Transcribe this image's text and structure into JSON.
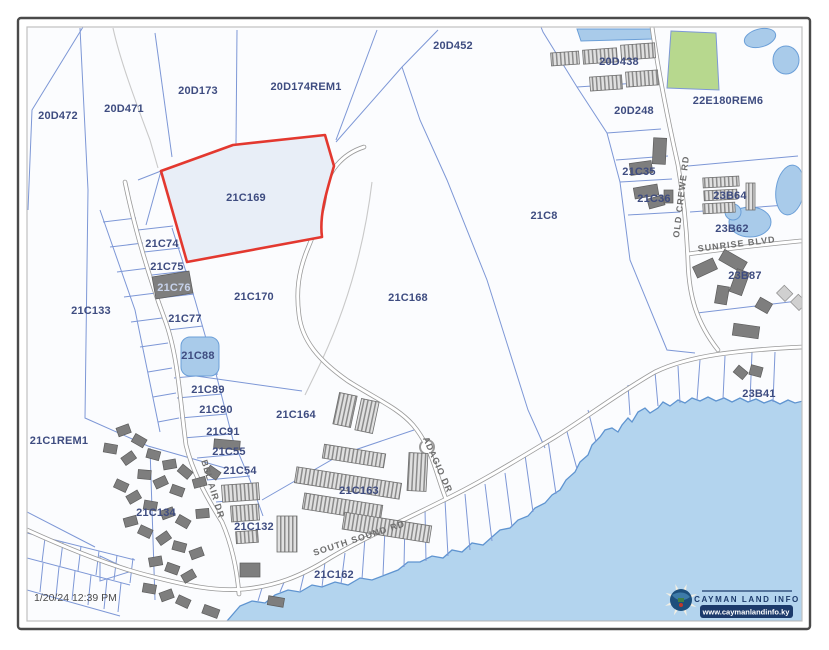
{
  "window": {
    "timestamp": "1/20/24 12:39 PM"
  },
  "logo": {
    "title": "CAYMAN LAND INFO",
    "url": "www.caymanlandinfo.ky"
  },
  "selected_parcel": {
    "id": "21C169",
    "outline_color": "#e3382f",
    "fill_color": "#e8eef7"
  },
  "colors": {
    "parcel_line": "#7d97d6",
    "water": "#b3d4ee",
    "green_parcel": "#b7d88e",
    "parcel_label": "#3e4c80",
    "road_label": "#6e6e6e",
    "building": "#7e7e7e"
  },
  "parcel_labels": [
    {
      "text": "20D472",
      "x": 58,
      "y": 119
    },
    {
      "text": "20D471",
      "x": 124,
      "y": 112
    },
    {
      "text": "20D173",
      "x": 198,
      "y": 94
    },
    {
      "text": "20D174REM1",
      "x": 306,
      "y": 90
    },
    {
      "text": "20D452",
      "x": 453,
      "y": 49
    },
    {
      "text": "20D438",
      "x": 619,
      "y": 65
    },
    {
      "text": "20D248",
      "x": 634,
      "y": 114
    },
    {
      "text": "22E180REM6",
      "x": 728,
      "y": 104
    },
    {
      "text": "21C35",
      "x": 639,
      "y": 175
    },
    {
      "text": "21C36",
      "x": 654,
      "y": 202
    },
    {
      "text": "23B64",
      "x": 730,
      "y": 199
    },
    {
      "text": "23B62",
      "x": 732,
      "y": 232
    },
    {
      "text": "23B87",
      "x": 745,
      "y": 279
    },
    {
      "text": "23B41",
      "x": 759,
      "y": 397
    },
    {
      "text": "21C8",
      "x": 544,
      "y": 219
    },
    {
      "text": "21C169",
      "x": 246,
      "y": 201
    },
    {
      "text": "21C170",
      "x": 254,
      "y": 300
    },
    {
      "text": "21C168",
      "x": 408,
      "y": 301
    },
    {
      "text": "21C133",
      "x": 91,
      "y": 314
    },
    {
      "text": "21C74",
      "x": 162,
      "y": 247
    },
    {
      "text": "21C75",
      "x": 167,
      "y": 270
    },
    {
      "text": "21C76",
      "x": 174,
      "y": 291,
      "light": true
    },
    {
      "text": "21C77",
      "x": 185,
      "y": 322
    },
    {
      "text": "21C88",
      "x": 198,
      "y": 359
    },
    {
      "text": "21C89",
      "x": 208,
      "y": 393
    },
    {
      "text": "21C90",
      "x": 216,
      "y": 413
    },
    {
      "text": "21C91",
      "x": 223,
      "y": 435
    },
    {
      "text": "21C55",
      "x": 229,
      "y": 455
    },
    {
      "text": "21C54",
      "x": 240,
      "y": 474
    },
    {
      "text": "21C132",
      "x": 254,
      "y": 530
    },
    {
      "text": "21C134",
      "x": 156,
      "y": 516
    },
    {
      "text": "21C1REM1",
      "x": 59,
      "y": 444
    },
    {
      "text": "21C164",
      "x": 296,
      "y": 418
    },
    {
      "text": "21C163",
      "x": 359,
      "y": 494
    },
    {
      "text": "21C162",
      "x": 334,
      "y": 578
    }
  ],
  "road_labels": [
    {
      "text": "OLD CREWE RD",
      "x": 684,
      "y": 197,
      "rot": -83
    },
    {
      "text": "SUNRISE BLVD",
      "x": 737,
      "y": 247,
      "rot": -7
    },
    {
      "text": "BEL AIR DR",
      "x": 210,
      "y": 490,
      "rot": 73
    },
    {
      "text": "ADAGIO DR",
      "x": 435,
      "y": 466,
      "rot": 66
    },
    {
      "text": "SOUTH SOUND RD",
      "x": 360,
      "y": 541,
      "rot": -18
    }
  ]
}
